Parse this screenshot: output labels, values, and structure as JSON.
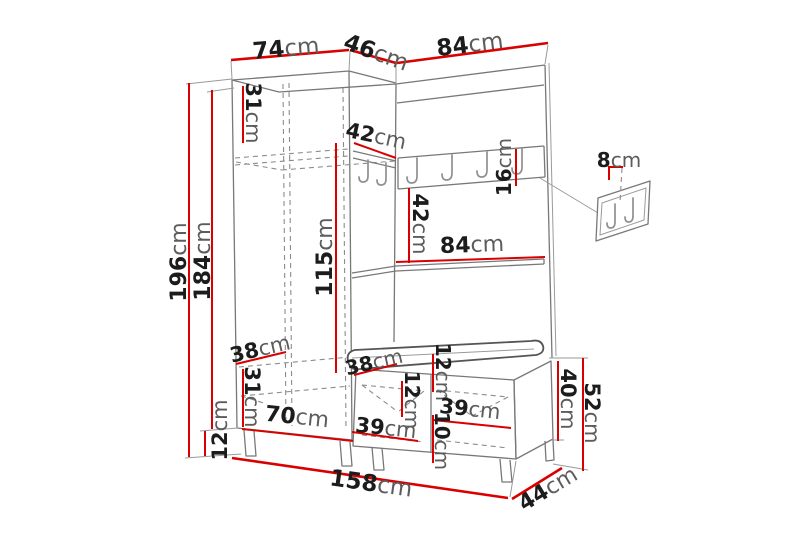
{
  "diagram": {
    "type": "furniture-dimension-diagram",
    "subject": "hallway wardrobe set with coat rack and shoe bench",
    "background": "#ffffff",
    "accent_red": "#d90000",
    "outline_gray": "#787878",
    "number_color": "#1c1c1c",
    "unit_color": "#5c5c5c",
    "hooks": {
      "rail_hooks": 4,
      "corner_hooks": 2,
      "wall_panel_hooks": 2
    }
  },
  "dimensions": {
    "top_width_left": {
      "value": "74",
      "unit": "cm"
    },
    "top_depth": {
      "value": "46",
      "unit": "cm"
    },
    "top_width_right": {
      "value": "84",
      "unit": "cm"
    },
    "total_height": {
      "value": "196",
      "unit": "cm"
    },
    "cabinet_height": {
      "value": "184",
      "unit": "cm"
    },
    "leg_height": {
      "value": "12",
      "unit": "cm"
    },
    "upper_shelf": {
      "value": "31",
      "unit": "cm"
    },
    "corner_rail": {
      "value": "42",
      "unit": "cm"
    },
    "rail_height": {
      "value": "16",
      "unit": "cm"
    },
    "wall_panel": {
      "value": "8",
      "unit": "cm"
    },
    "rail_to_shelf": {
      "value": "42",
      "unit": "cm"
    },
    "shelf_width": {
      "value": "84",
      "unit": "cm"
    },
    "interior_height": {
      "value": "115",
      "unit": "cm"
    },
    "lower_shelf": {
      "value": "38",
      "unit": "cm"
    },
    "lower_section": {
      "value": "31",
      "unit": "cm"
    },
    "cabinet_width": {
      "value": "70",
      "unit": "cm"
    },
    "bench_depth": {
      "value": "38",
      "unit": "cm"
    },
    "cushion_height": {
      "value": "12",
      "unit": "cm"
    },
    "drawer_height": {
      "value": "12",
      "unit": "cm"
    },
    "drawer_width_left": {
      "value": "39",
      "unit": "cm"
    },
    "drawer_width_right": {
      "value": "39",
      "unit": "cm"
    },
    "drawer_bottom": {
      "value": "10",
      "unit": "cm"
    },
    "bench_height": {
      "value": "40",
      "unit": "cm"
    },
    "bench_total_height": {
      "value": "52",
      "unit": "cm"
    },
    "total_width": {
      "value": "158",
      "unit": "cm"
    },
    "total_depth": {
      "value": "44",
      "unit": "cm"
    }
  }
}
